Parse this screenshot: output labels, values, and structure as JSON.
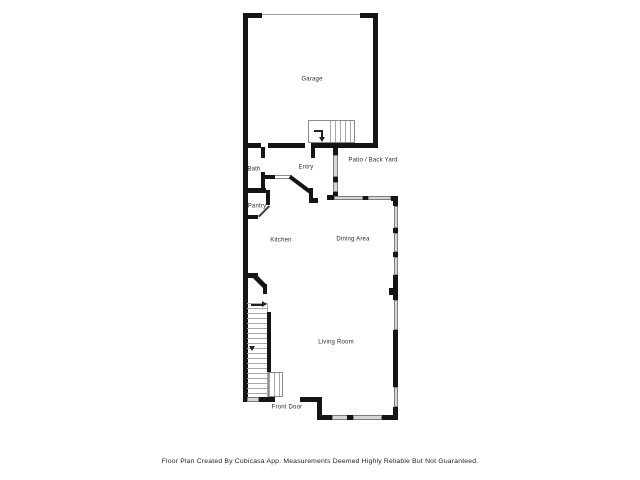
{
  "labels": {
    "garage": "Garage",
    "patio_back_yard": "Patio / Back Yard",
    "bath": "Bath",
    "entry": "Entry",
    "pantry": "Pantry",
    "kitchen": "Kitchen",
    "dining_area": "Dining Area",
    "living_room": "Living Room",
    "front_door": "Front Door"
  },
  "footer": {
    "disclaimer": "Floor Plan Created By Cubicasa App. Measurements Deemed Highly Reliable But Not Guaranteed."
  },
  "colors": {
    "wall": "#151515",
    "window": "#d6d6d6",
    "stair_line": "#a8a8a8",
    "text": "#2b2b2b"
  }
}
